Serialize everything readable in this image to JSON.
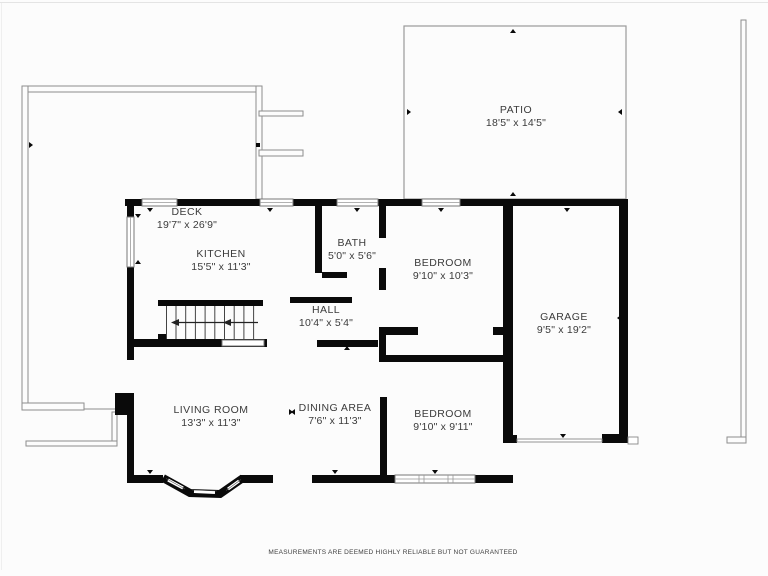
{
  "plan": {
    "background": "#fcfcfc",
    "wall_color": "#0a0a0a",
    "thin_line_color": "#8d8d8d",
    "text_color": "#3b3b3b"
  },
  "rooms": [
    {
      "slug": "deck",
      "name": "DECK",
      "dims": "19'7\" x 26'9\"",
      "cx": 187,
      "cy": 219
    },
    {
      "slug": "patio",
      "name": "PATIO",
      "dims": "18'5\" x 14'5\"",
      "cx": 516,
      "cy": 117
    },
    {
      "slug": "kitchen",
      "name": "KITCHEN",
      "dims": "15'5\" x 11'3\"",
      "cx": 221,
      "cy": 261
    },
    {
      "slug": "bath",
      "name": "BATH",
      "dims": "5'0\" x 5'6\"",
      "cx": 352,
      "cy": 250
    },
    {
      "slug": "bedroom-1",
      "name": "BEDROOM",
      "dims": "9'10\" x 10'3\"",
      "cx": 443,
      "cy": 270
    },
    {
      "slug": "garage",
      "name": "GARAGE",
      "dims": "9'5\" x 19'2\"",
      "cx": 564,
      "cy": 324
    },
    {
      "slug": "hall",
      "name": "HALL",
      "dims": "10'4\" x 5'4\"",
      "cx": 326,
      "cy": 317
    },
    {
      "slug": "living-room",
      "name": "LIVING ROOM",
      "dims": "13'3\" x 11'3\"",
      "cx": 211,
      "cy": 417
    },
    {
      "slug": "dining-area",
      "name": "DINING AREA",
      "dims": "7'6\" x 11'3\"",
      "cx": 335,
      "cy": 415
    },
    {
      "slug": "bedroom-2",
      "name": "BEDROOM",
      "dims": "9'10\" x 9'11\"",
      "cx": 443,
      "cy": 421
    }
  ],
  "disclaimer": "MEASUREMENTS ARE DEEMED HIGHLY RELIABLE BUT NOT GUARANTEED"
}
